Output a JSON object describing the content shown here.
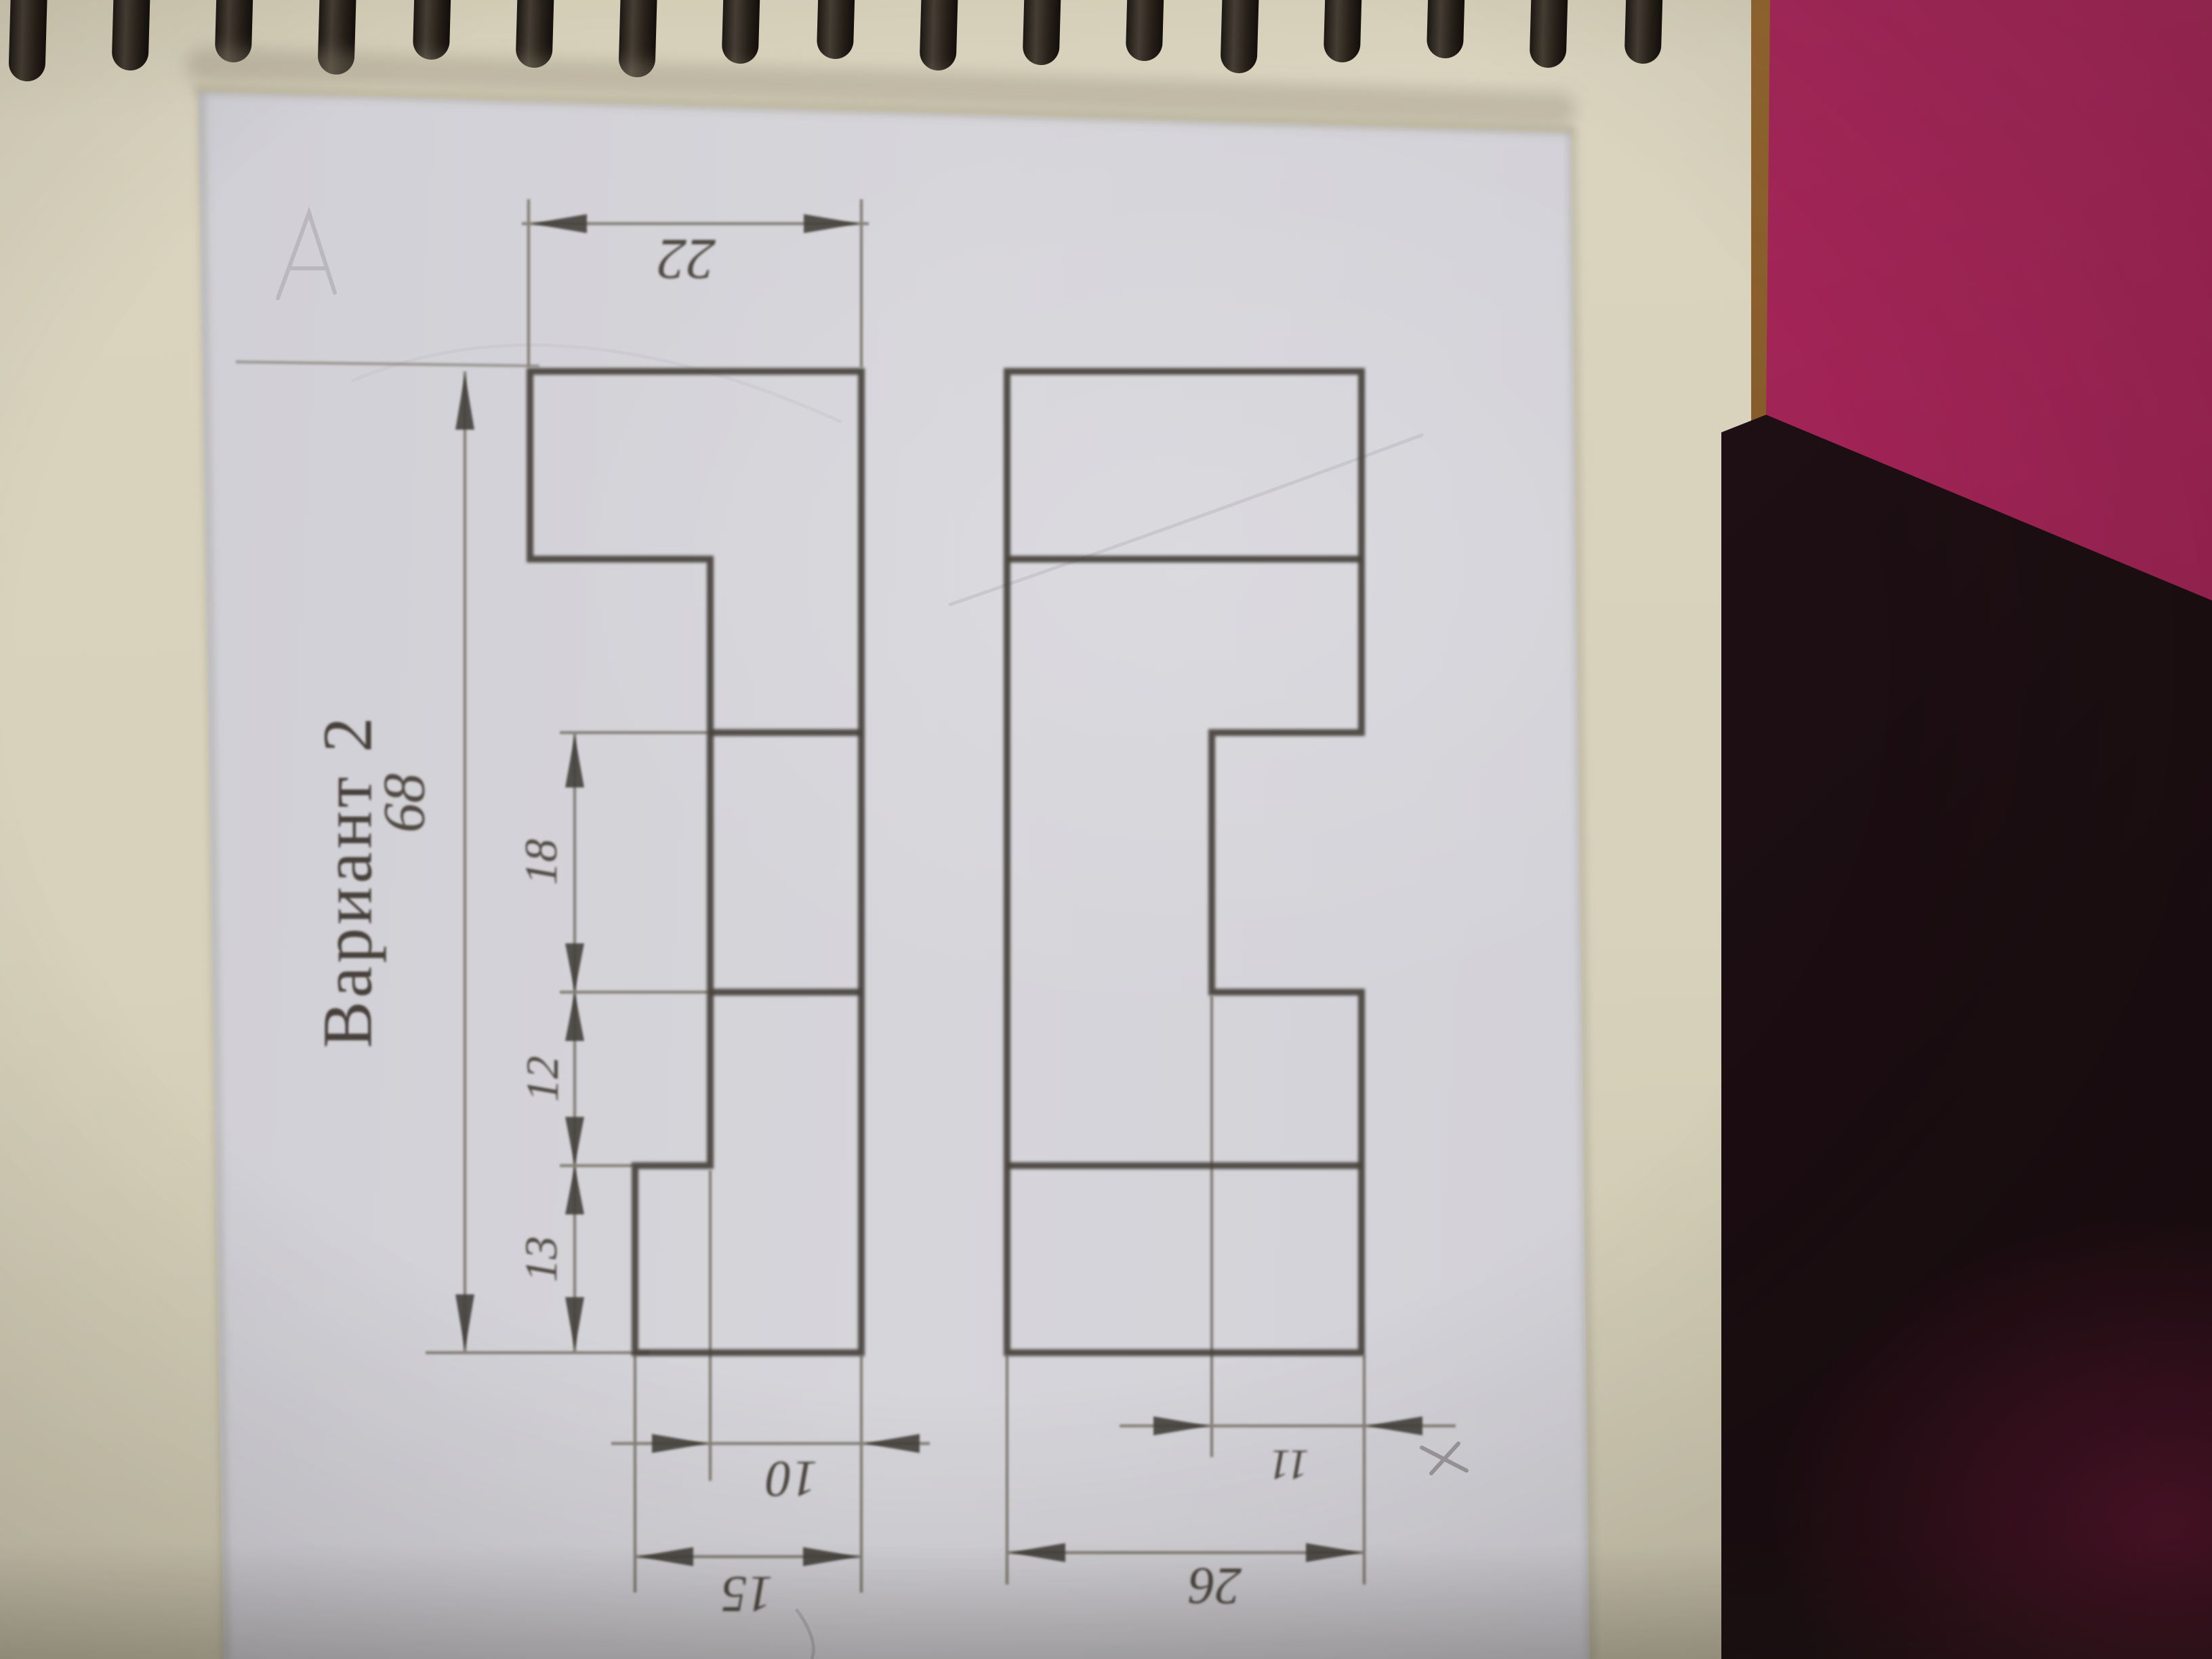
{
  "photo": {
    "title_label": "Вариант 2",
    "spiral_coil_count": 17,
    "colors": {
      "pink_fabric": "#a02455",
      "dark_surface": "#1d0f13",
      "notebook_cream": "#d8d2bc",
      "sheet_white": "#d3d2d8",
      "pencil_line": "#44403a"
    }
  },
  "drawing": {
    "description": "two orthographic views of a stepped block",
    "dims": {
      "front_total_width": "22",
      "front_total_height": "68",
      "notch_height": "18",
      "step_mid": "12",
      "step_bottom": "13",
      "front_notch_depth": "10",
      "front_bottom_width": "15",
      "side_notch_depth": "11",
      "side_total_width": "26"
    }
  }
}
